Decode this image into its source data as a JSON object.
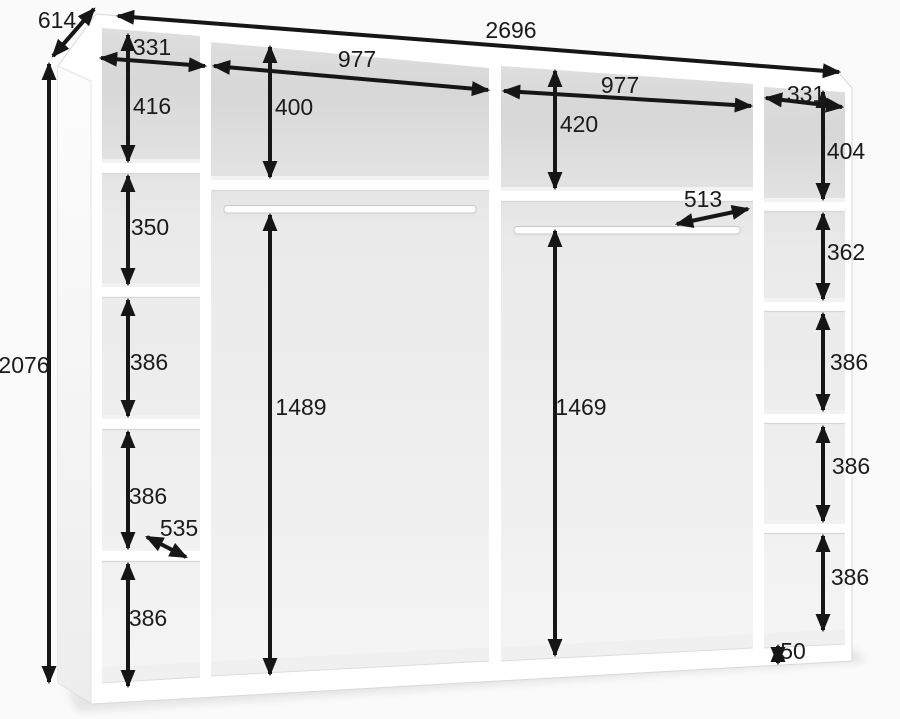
{
  "diagram": {
    "overall": {
      "width": "2696",
      "depth": "614",
      "height": "2076"
    },
    "left_column": {
      "width": "331",
      "compartments": [
        "416",
        "350",
        "386",
        "386",
        "386"
      ],
      "shelf_depth": "535"
    },
    "middle_left": {
      "width": "977",
      "top_compartment": "400",
      "hanging_space": "1489"
    },
    "middle_right": {
      "width": "977",
      "top_compartment": "420",
      "hanging_space": "1469",
      "rail_depth": "513"
    },
    "right_column": {
      "width": "331",
      "compartments": [
        "404",
        "362",
        "386",
        "386",
        "386"
      ]
    },
    "plinth": {
      "height": "50"
    }
  }
}
